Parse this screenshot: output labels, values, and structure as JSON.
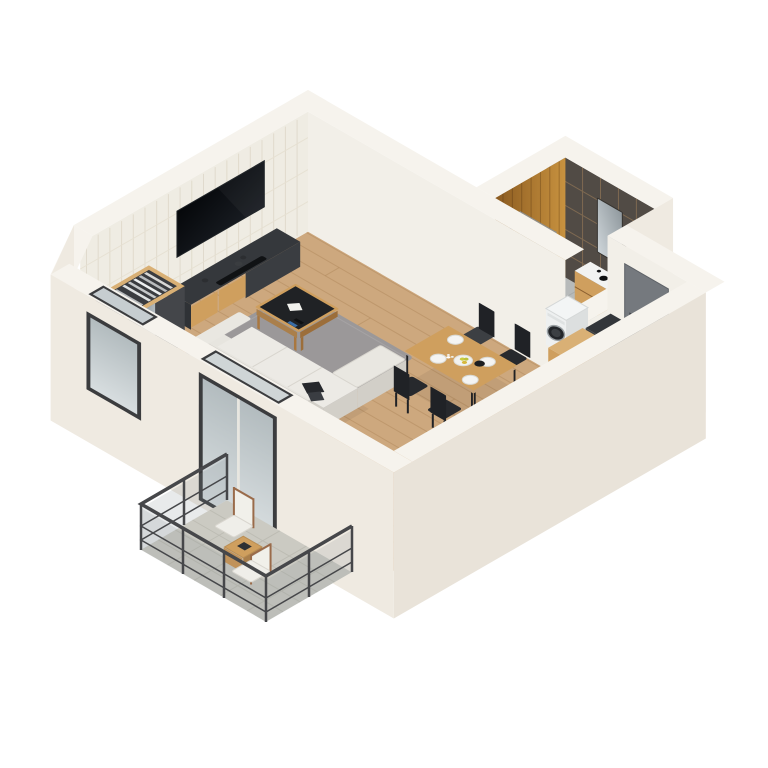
{
  "scene": {
    "type": "3d-isometric-floor-plan",
    "view": "isometric-top-down",
    "background": "#ffffff",
    "text_labels": []
  },
  "rooms": [
    {
      "name": "living-room",
      "floor": "light-oak-plank",
      "furniture": [
        "wall-mounted-tv",
        "media-console-with-oak-drawers",
        "decor-vases",
        "soundbar",
        "open-wardrobe-with-clothes",
        "gray-rug",
        "white-l-shaped-sofa",
        "black-throw-pillows",
        "coffee-table-black-top",
        "white-paper",
        "remote-controls",
        "dining-table-oak",
        "dining-chairs-black",
        "plates",
        "fruit-bowl",
        "black-jug",
        "flower-vase",
        "window",
        "sliding-glass-door"
      ]
    },
    {
      "name": "bathroom",
      "floor": "gray-tile",
      "walls": [
        "warm-wood-panel",
        "dark-brown-tile"
      ],
      "furniture": [
        "toilet",
        "flush-plate",
        "toilet-paper-holder",
        "glass-shower-enclosure",
        "shower-fixture",
        "wood-vanity-with-white-sink",
        "black-faucet",
        "rounded-mirror",
        "washing-machine",
        "low-partition-wall"
      ]
    },
    {
      "name": "kitchen-hall",
      "floor": "light-oak-plank",
      "furniture": [
        "dark-drawer-cabinet",
        "white-counter",
        "induction-cooktop",
        "black-sink",
        "tall-oak-cabinet",
        "entrance-door-gray",
        "radiator-vent"
      ]
    },
    {
      "name": "balcony",
      "floor": "stone-tile",
      "furniture": [
        "metal-glass-railing",
        "wood-lounge-chair-white-cushion",
        "wood-lounge-chair-white-cushion",
        "wood-side-table",
        "dark-book"
      ]
    }
  ],
  "counts": {
    "dining_chairs": 4,
    "plates": 4,
    "balcony_chairs": 2,
    "cooktop_burners": 4
  },
  "colors": {
    "wall_top": "#f6f3ed",
    "wall_outer": "#efeae1",
    "wall_outer2": "#e9e3d9",
    "wall_face": "#f2efe8",
    "wallpaper": "#efece3",
    "wallpaper_line": "#ddd6c7",
    "floor_wood": "#cda87e",
    "floor_line": "#b0885c",
    "rug": "#9b9899",
    "bath_floor": "#b7baba",
    "bath_line": "#a4a8a8",
    "tile": "#514b45",
    "grout": "#8d7355",
    "wood_wall_light": "#c8923f",
    "wood_wall_dark": "#8a5a20",
    "oak": "#cf9f5e",
    "oak_dark": "#aa7f4b",
    "oak_light": "#d9b075",
    "dark_cabinet": "#3c3f43",
    "dark_cabinet_top": "#33363a",
    "black": "#17181b",
    "sofa": "#eceae5",
    "sofa_mid": "#e0ddd6",
    "sofa_dark": "#d2cfc8",
    "pillow": "#26282c",
    "door": "#75797e",
    "door_dark": "#4a4e53",
    "counter": "#edeae3",
    "washer": "#eef0f0",
    "railing": "#46474a",
    "balcony_floor": "#cbcac2",
    "balcony_line": "#b4b3aa",
    "chair_black": "#26282c",
    "mirror": "#b7bec2",
    "white": "#f2f3f2",
    "fruit": "#c9cc3e"
  }
}
